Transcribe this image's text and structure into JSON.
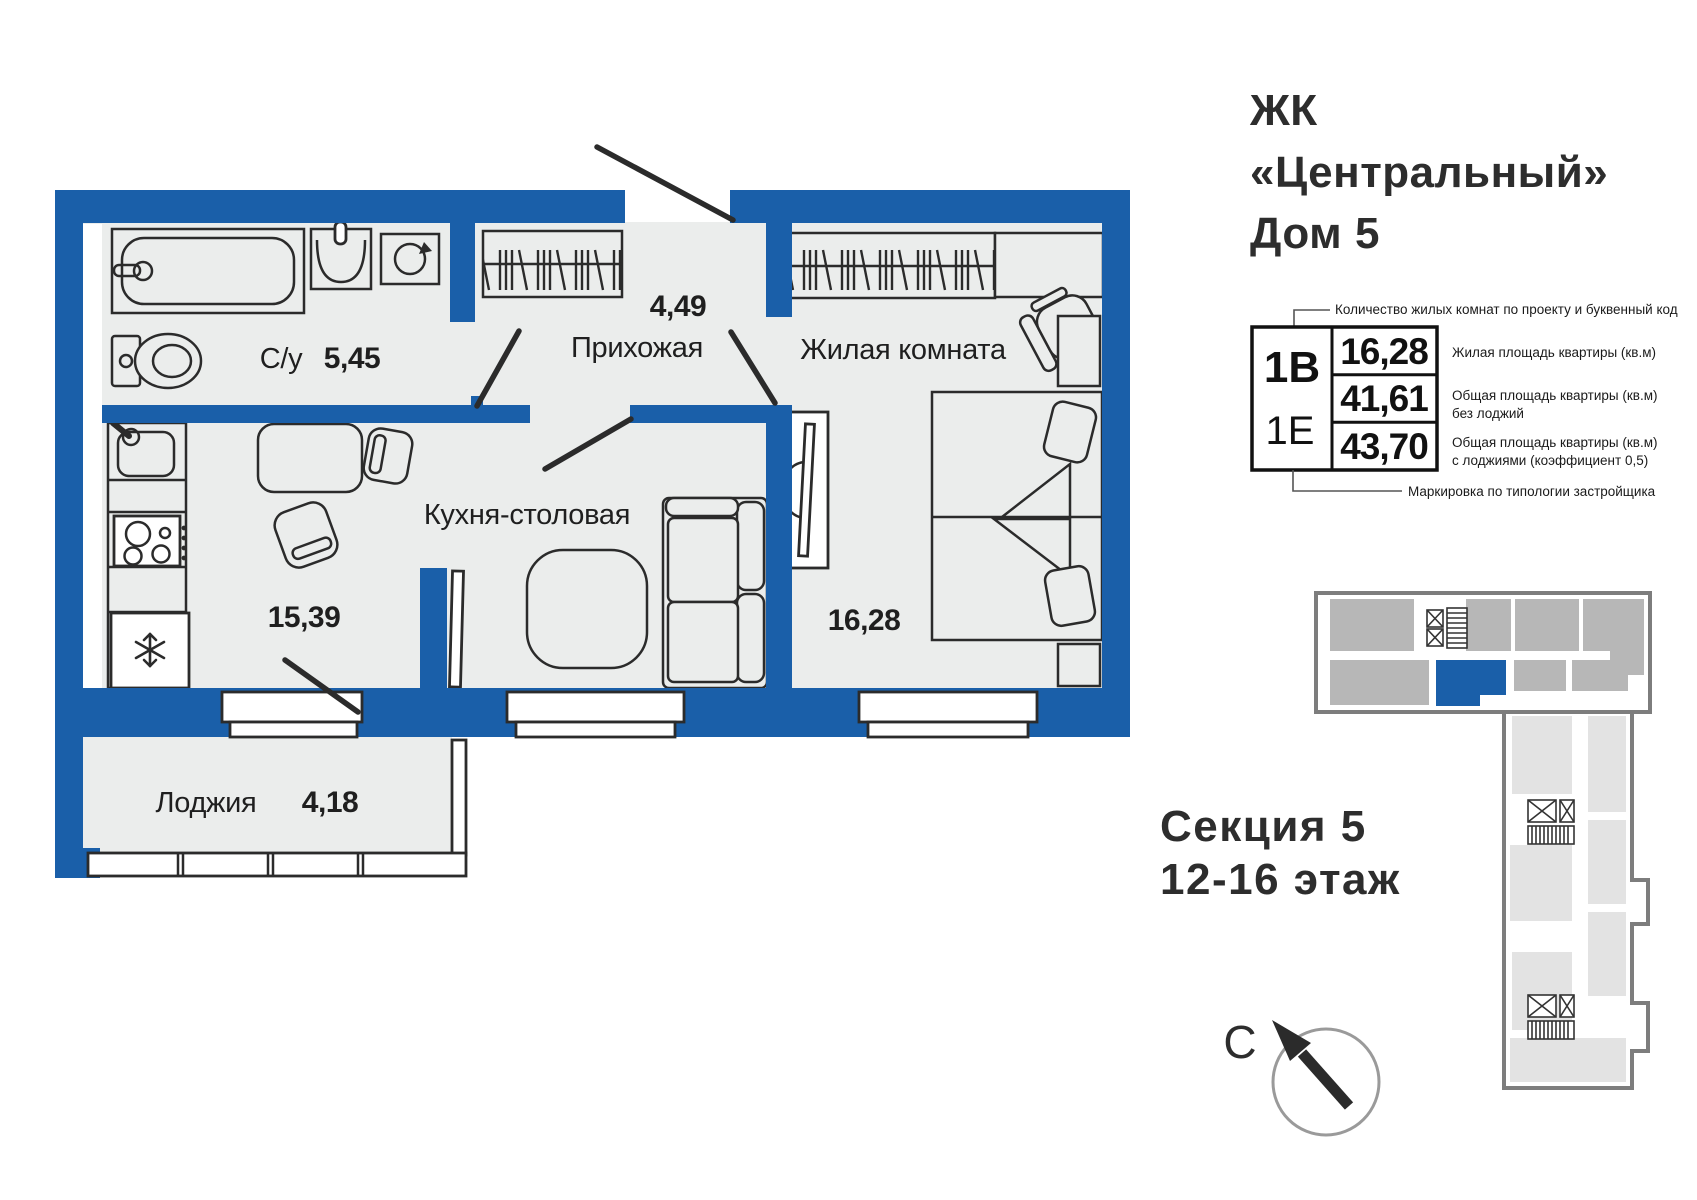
{
  "title": {
    "lines": [
      "ЖК",
      "«Центральный»",
      "Дом 5"
    ]
  },
  "legend": {
    "top_note": "Количество жилых комнат по проекту и буквенный код",
    "bottom_note": "Маркировка по типологии застройщика",
    "code_bold": "1В",
    "code_light": "1Е",
    "row1": {
      "value": "16,28",
      "label1": "Жилая площадь квартиры (кв.м)",
      "label2": ""
    },
    "row2": {
      "value": "41,61",
      "label1": "Общая площадь квартиры (кв.м)",
      "label2": "без лоджий"
    },
    "row3": {
      "value": "43,70",
      "label1": "Общая площадь квартиры (кв.м)",
      "label2": "с лоджиями (коэффициент 0,5)"
    }
  },
  "rooms": {
    "bathroom": {
      "name": "С/у",
      "area": "5,45"
    },
    "hallway": {
      "name": "Прихожая",
      "area": "4,49"
    },
    "living": {
      "name": "Жилая комната",
      "area": "16,28"
    },
    "kitchen": {
      "name": "Кухня-столовая",
      "area": "15,39"
    },
    "loggia": {
      "name": "Лоджия",
      "area": "4,18"
    }
  },
  "section": {
    "line1": "Секция 5",
    "line2": "12-16 этаж"
  },
  "compass": {
    "north": "С"
  },
  "colors": {
    "wall": "#1a5fa9",
    "floor": "#ebedec",
    "outline": "#2b2b2b",
    "map_outline": "#7d7d7d",
    "map_unit": "#b7b7b7",
    "map_unit_light": "#e3e3e3"
  }
}
